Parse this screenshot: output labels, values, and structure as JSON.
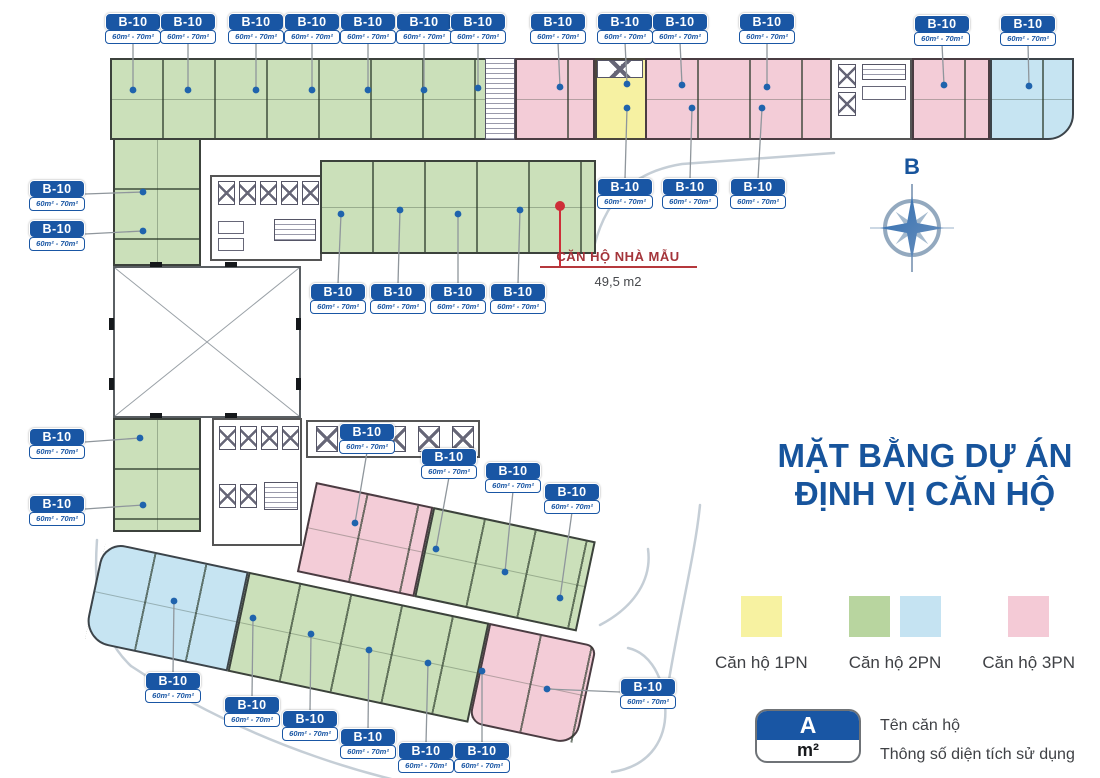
{
  "title": {
    "line1": "MẶT BẰNG DỰ ÁN",
    "line2": "ĐỊNH VỊ CĂN HỘ"
  },
  "compass": {
    "label": "B"
  },
  "unit_chip": {
    "code": "B-10",
    "area": "60m² - 70m²"
  },
  "sample_annotation": {
    "name": "CĂN HỘ NHÀ MẪU",
    "area": "49,5 m2"
  },
  "legend": {
    "items": [
      {
        "label": "Căn hộ 1PN",
        "colors": [
          "#f7f2a1"
        ]
      },
      {
        "label": "Căn hộ 2PN",
        "colors": [
          "#b8d59f",
          "#c5e3f2"
        ]
      },
      {
        "label": "Căn hộ 3PN",
        "colors": [
          "#f4cad6"
        ]
      }
    ]
  },
  "key_legend": {
    "code": "A",
    "unit": "m²",
    "code_desc": "Tên căn hộ",
    "unit_desc": "Thông số diện tích sử dụng"
  },
  "colors": {
    "chip_blue": "#1956a4",
    "dot": "#1f63ad",
    "leader": "#8f969c",
    "red": "#ce2e38",
    "green": "#cbe0ba",
    "pink": "#f3ccd7",
    "yellow": "#f6f1a2",
    "blue": "#c6e4f2"
  },
  "plan": {
    "chips": [
      {
        "x": 133,
        "y": 13,
        "side": "down",
        "dot": [
          133,
          90
        ]
      },
      {
        "x": 188,
        "y": 13,
        "side": "down",
        "dot": [
          188,
          90
        ]
      },
      {
        "x": 256,
        "y": 13,
        "side": "down",
        "dot": [
          256,
          90
        ]
      },
      {
        "x": 312,
        "y": 13,
        "side": "down",
        "dot": [
          312,
          90
        ]
      },
      {
        "x": 368,
        "y": 13,
        "side": "down",
        "dot": [
          368,
          90
        ]
      },
      {
        "x": 424,
        "y": 13,
        "side": "down",
        "dot": [
          424,
          90
        ]
      },
      {
        "x": 478,
        "y": 13,
        "side": "down",
        "dot": [
          478,
          88
        ]
      },
      {
        "x": 558,
        "y": 13,
        "side": "down",
        "dot": [
          560,
          87
        ]
      },
      {
        "x": 625,
        "y": 13,
        "side": "down",
        "dot": [
          627,
          84
        ]
      },
      {
        "x": 680,
        "y": 13,
        "side": "down",
        "dot": [
          682,
          85
        ]
      },
      {
        "x": 767,
        "y": 13,
        "side": "down",
        "dot": [
          767,
          87
        ]
      },
      {
        "x": 942,
        "y": 15,
        "side": "down",
        "dot": [
          944,
          85
        ]
      },
      {
        "x": 1028,
        "y": 15,
        "side": "down",
        "dot": [
          1029,
          86
        ]
      },
      {
        "x": 57,
        "y": 180,
        "side": "right",
        "dot": [
          143,
          192
        ]
      },
      {
        "x": 57,
        "y": 220,
        "side": "right",
        "dot": [
          143,
          231
        ]
      },
      {
        "x": 57,
        "y": 428,
        "side": "right",
        "dot": [
          140,
          438
        ]
      },
      {
        "x": 57,
        "y": 495,
        "side": "right",
        "dot": [
          143,
          505
        ]
      },
      {
        "x": 625,
        "y": 178,
        "side": "up",
        "dot": [
          627,
          108
        ]
      },
      {
        "x": 690,
        "y": 178,
        "side": "up",
        "dot": [
          692,
          108
        ]
      },
      {
        "x": 758,
        "y": 178,
        "side": "up",
        "dot": [
          762,
          108
        ]
      },
      {
        "x": 338,
        "y": 283,
        "side": "up",
        "dot": [
          341,
          214
        ]
      },
      {
        "x": 398,
        "y": 283,
        "side": "up",
        "dot": [
          400,
          210
        ]
      },
      {
        "x": 458,
        "y": 283,
        "side": "up",
        "dot": [
          458,
          214
        ]
      },
      {
        "x": 518,
        "y": 283,
        "side": "up",
        "dot": [
          520,
          210
        ]
      },
      {
        "x": 367,
        "y": 423,
        "side": "down",
        "dot": [
          355,
          523
        ]
      },
      {
        "x": 449,
        "y": 448,
        "side": "down",
        "dot": [
          436,
          549
        ]
      },
      {
        "x": 513,
        "y": 462,
        "side": "down",
        "dot": [
          505,
          572
        ]
      },
      {
        "x": 572,
        "y": 483,
        "side": "down",
        "dot": [
          560,
          598
        ]
      },
      {
        "x": 173,
        "y": 672,
        "side": "up",
        "dot": [
          174,
          601
        ]
      },
      {
        "x": 252,
        "y": 696,
        "side": "up",
        "dot": [
          253,
          618
        ]
      },
      {
        "x": 310,
        "y": 710,
        "side": "up",
        "dot": [
          311,
          634
        ]
      },
      {
        "x": 368,
        "y": 728,
        "side": "up",
        "dot": [
          369,
          650
        ]
      },
      {
        "x": 426,
        "y": 742,
        "side": "up",
        "dot": [
          428,
          663
        ]
      },
      {
        "x": 482,
        "y": 742,
        "side": "up",
        "dot": [
          482,
          671
        ]
      },
      {
        "x": 648,
        "y": 678,
        "side": "left",
        "dot": [
          547,
          689
        ]
      }
    ]
  }
}
